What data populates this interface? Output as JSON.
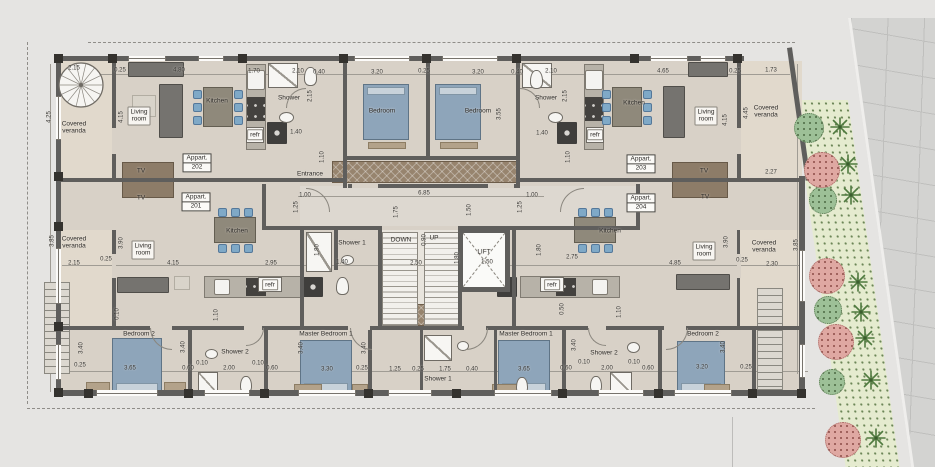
{
  "plan": {
    "apartments": [
      {
        "title": "Appart.",
        "number": "202",
        "x": 197,
        "y": 163
      },
      {
        "title": "Appart.",
        "number": "201",
        "x": 196,
        "y": 202
      },
      {
        "title": "Appart.",
        "number": "203",
        "x": 641,
        "y": 164
      },
      {
        "title": "Appart.",
        "number": "204",
        "x": 641,
        "y": 203
      }
    ],
    "labels": [
      {
        "t": "Covered\nveranda",
        "x": 74,
        "y": 128,
        "cls": "room"
      },
      {
        "t": "Covered\nveranda",
        "x": 74,
        "y": 243,
        "cls": "room"
      },
      {
        "t": "Covered\nveranda",
        "x": 766,
        "y": 112,
        "cls": "room"
      },
      {
        "t": "Covered\nveranda",
        "x": 764,
        "y": 247,
        "cls": "room"
      },
      {
        "t": "Living\nroom",
        "x": 139,
        "y": 116,
        "cls": "roombox"
      },
      {
        "t": "Living\nroom",
        "x": 706,
        "y": 116,
        "cls": "roombox"
      },
      {
        "t": "Living\nroom",
        "x": 143,
        "y": 250,
        "cls": "roombox"
      },
      {
        "t": "Living\nroom",
        "x": 704,
        "y": 251,
        "cls": "roombox"
      },
      {
        "t": "Kitchen",
        "x": 217,
        "y": 101,
        "cls": "room"
      },
      {
        "t": "Kitchen",
        "x": 634,
        "y": 103,
        "cls": "room"
      },
      {
        "t": "Kitchen",
        "x": 237,
        "y": 231,
        "cls": "room"
      },
      {
        "t": "Kitchen",
        "x": 610,
        "y": 231,
        "cls": "room"
      },
      {
        "t": "Shower",
        "x": 289,
        "y": 98,
        "cls": "room"
      },
      {
        "t": "Shower",
        "x": 546,
        "y": 98,
        "cls": "room"
      },
      {
        "t": "Shower 1",
        "x": 352,
        "y": 243,
        "cls": "room"
      },
      {
        "t": "Shower 1",
        "x": 438,
        "y": 379,
        "cls": "room"
      },
      {
        "t": "Shower 2",
        "x": 235,
        "y": 352,
        "cls": "room"
      },
      {
        "t": "Shower 2",
        "x": 604,
        "y": 353,
        "cls": "room"
      },
      {
        "t": "Bedroom",
        "x": 382,
        "y": 111,
        "cls": "room"
      },
      {
        "t": "Bedroom",
        "x": 478,
        "y": 111,
        "cls": "room"
      },
      {
        "t": "Bedroom 2",
        "x": 139,
        "y": 334,
        "cls": "room"
      },
      {
        "t": "Bedroom 2",
        "x": 703,
        "y": 334,
        "cls": "room"
      },
      {
        "t": "Master Bedroom 1",
        "x": 326,
        "y": 334,
        "cls": "room"
      },
      {
        "t": "Master Bedroom 1",
        "x": 526,
        "y": 334,
        "cls": "room"
      },
      {
        "t": "refr",
        "x": 255,
        "y": 135,
        "cls": "roombox"
      },
      {
        "t": "refr",
        "x": 595,
        "y": 135,
        "cls": "roombox"
      },
      {
        "t": "refr",
        "x": 270,
        "y": 285,
        "cls": "roombox"
      },
      {
        "t": "refr",
        "x": 552,
        "y": 285,
        "cls": "roombox"
      },
      {
        "t": "TV",
        "x": 141,
        "y": 171,
        "cls": "room"
      },
      {
        "t": "TV",
        "x": 141,
        "y": 198,
        "cls": "room"
      },
      {
        "t": "TV",
        "x": 704,
        "y": 171,
        "cls": "room"
      },
      {
        "t": "TV",
        "x": 705,
        "y": 197,
        "cls": "room"
      },
      {
        "t": "Entrance",
        "x": 310,
        "y": 174,
        "cls": "room"
      },
      {
        "t": "DOWN",
        "x": 401,
        "y": 240,
        "cls": "room"
      },
      {
        "t": "UP",
        "x": 434,
        "y": 238,
        "cls": "room"
      },
      {
        "t": "LIFT",
        "x": 484,
        "y": 252,
        "cls": "room"
      }
    ],
    "dims": [
      {
        "t": "2.15",
        "x": 74,
        "y": 69
      },
      {
        "t": "0.25",
        "x": 120,
        "y": 71
      },
      {
        "t": "4.80",
        "x": 179,
        "y": 71
      },
      {
        "t": "1.70",
        "x": 254,
        "y": 72
      },
      {
        "t": "2.10",
        "x": 298,
        "y": 72
      },
      {
        "t": "0.40",
        "x": 319,
        "y": 73
      },
      {
        "t": "3.20",
        "x": 377,
        "y": 73
      },
      {
        "t": "0.25",
        "x": 424,
        "y": 72
      },
      {
        "t": "3.20",
        "x": 478,
        "y": 73
      },
      {
        "t": "0.40",
        "x": 517,
        "y": 73
      },
      {
        "t": "2.10",
        "x": 551,
        "y": 72
      },
      {
        "t": "4.65",
        "x": 663,
        "y": 72
      },
      {
        "t": "0.25",
        "x": 735,
        "y": 72
      },
      {
        "t": "1.73",
        "x": 771,
        "y": 71
      },
      {
        "t": "4.25",
        "x": 50,
        "y": 117,
        "r": 90
      },
      {
        "t": "4.15",
        "x": 122,
        "y": 117,
        "r": 90
      },
      {
        "t": "2.15",
        "x": 311,
        "y": 96,
        "r": 90
      },
      {
        "t": "2.15",
        "x": 566,
        "y": 96,
        "r": 90
      },
      {
        "t": "3.55",
        "x": 500,
        "y": 114,
        "r": 90
      },
      {
        "t": "4.45",
        "x": 747,
        "y": 113,
        "r": 90
      },
      {
        "t": "4.15",
        "x": 726,
        "y": 120,
        "r": 90
      },
      {
        "t": "1.10",
        "x": 323,
        "y": 157,
        "r": 90
      },
      {
        "t": "1.10",
        "x": 569,
        "y": 157,
        "r": 90
      },
      {
        "t": "1.40",
        "x": 296,
        "y": 133
      },
      {
        "t": "1.40",
        "x": 542,
        "y": 134
      },
      {
        "t": "2.27",
        "x": 771,
        "y": 173
      },
      {
        "t": "1.00",
        "x": 305,
        "y": 196
      },
      {
        "t": "6.85",
        "x": 424,
        "y": 194
      },
      {
        "t": "1.00",
        "x": 532,
        "y": 196
      },
      {
        "t": "2.50",
        "x": 416,
        "y": 264
      },
      {
        "t": "1.50",
        "x": 487,
        "y": 263
      },
      {
        "t": "1.40",
        "x": 342,
        "y": 263
      },
      {
        "t": "2.15",
        "x": 74,
        "y": 264
      },
      {
        "t": "0.25",
        "x": 106,
        "y": 260
      },
      {
        "t": "4.15",
        "x": 173,
        "y": 264
      },
      {
        "t": "2.95",
        "x": 271,
        "y": 264
      },
      {
        "t": "2.75",
        "x": 572,
        "y": 258
      },
      {
        "t": "4.85",
        "x": 675,
        "y": 264
      },
      {
        "t": "0.25",
        "x": 742,
        "y": 261
      },
      {
        "t": "2.30",
        "x": 772,
        "y": 265
      },
      {
        "t": "1.25",
        "x": 297,
        "y": 207,
        "r": 90
      },
      {
        "t": "1.75",
        "x": 397,
        "y": 212,
        "r": 90
      },
      {
        "t": "1.50",
        "x": 470,
        "y": 210,
        "r": 90
      },
      {
        "t": "1.25",
        "x": 521,
        "y": 207,
        "r": 90
      },
      {
        "t": "1.80",
        "x": 458,
        "y": 258,
        "r": 90
      },
      {
        "t": "0.90",
        "x": 425,
        "y": 240,
        "r": 90
      },
      {
        "t": "3.85",
        "x": 53,
        "y": 241,
        "r": 90
      },
      {
        "t": "3.90",
        "x": 122,
        "y": 243,
        "r": 90
      },
      {
        "t": "1.80",
        "x": 318,
        "y": 250,
        "r": 90
      },
      {
        "t": "1.80",
        "x": 540,
        "y": 250,
        "r": 90
      },
      {
        "t": "3.90",
        "x": 727,
        "y": 242,
        "r": 90
      },
      {
        "t": "3.85",
        "x": 797,
        "y": 245,
        "r": 90
      },
      {
        "t": "0.25",
        "x": 80,
        "y": 366
      },
      {
        "t": "3.65",
        "x": 130,
        "y": 369
      },
      {
        "t": "0.60",
        "x": 188,
        "y": 369
      },
      {
        "t": "0.10",
        "x": 202,
        "y": 364
      },
      {
        "t": "2.00",
        "x": 229,
        "y": 369
      },
      {
        "t": "0.10",
        "x": 258,
        "y": 364
      },
      {
        "t": "0.60",
        "x": 272,
        "y": 369
      },
      {
        "t": "3.30",
        "x": 327,
        "y": 370
      },
      {
        "t": "0.25",
        "x": 362,
        "y": 369
      },
      {
        "t": "1.25",
        "x": 395,
        "y": 370
      },
      {
        "t": "0.25",
        "x": 418,
        "y": 370
      },
      {
        "t": "1.75",
        "x": 445,
        "y": 370
      },
      {
        "t": "0.40",
        "x": 472,
        "y": 370
      },
      {
        "t": "3.65",
        "x": 524,
        "y": 370
      },
      {
        "t": "0.60",
        "x": 566,
        "y": 369
      },
      {
        "t": "2.00",
        "x": 607,
        "y": 369
      },
      {
        "t": "0.10",
        "x": 584,
        "y": 363
      },
      {
        "t": "0.10",
        "x": 634,
        "y": 363
      },
      {
        "t": "0.60",
        "x": 648,
        "y": 369
      },
      {
        "t": "3.20",
        "x": 702,
        "y": 368
      },
      {
        "t": "0.25",
        "x": 746,
        "y": 368
      },
      {
        "t": "3.40",
        "x": 82,
        "y": 348,
        "r": 90
      },
      {
        "t": "3.40",
        "x": 184,
        "y": 347,
        "r": 90
      },
      {
        "t": "3.40",
        "x": 302,
        "y": 348,
        "r": 90
      },
      {
        "t": "3.40",
        "x": 365,
        "y": 348,
        "r": 90
      },
      {
        "t": "3.40",
        "x": 575,
        "y": 345,
        "r": 90
      },
      {
        "t": "3.40",
        "x": 724,
        "y": 347,
        "r": 90
      },
      {
        "t": "1.10",
        "x": 217,
        "y": 315,
        "r": 90
      },
      {
        "t": "1.10",
        "x": 620,
        "y": 312,
        "r": 90
      },
      {
        "t": "0.50",
        "x": 563,
        "y": 309,
        "r": 90
      },
      {
        "t": "0.10",
        "x": 118,
        "y": 314,
        "r": 90
      }
    ],
    "garden": {
      "trees_green": [
        [
          809,
          128,
          15
        ],
        [
          823,
          200,
          14
        ],
        [
          828,
          310,
          14
        ],
        [
          832,
          382,
          13
        ]
      ],
      "trees_pink": [
        [
          822,
          170,
          18
        ],
        [
          827,
          276,
          18
        ],
        [
          836,
          342,
          18
        ],
        [
          843,
          440,
          18
        ]
      ],
      "palms": [
        [
          840,
          127
        ],
        [
          848,
          164
        ],
        [
          851,
          195
        ],
        [
          858,
          282
        ],
        [
          861,
          312
        ],
        [
          865,
          338
        ],
        [
          871,
          380
        ],
        [
          876,
          438
        ]
      ]
    },
    "colors": {
      "bed": "#8ea5ba",
      "chair": "#7fa9c7",
      "wall": "#5f5e5c",
      "tree_green": "#9dc097",
      "tree_pink": "#dfa8a2",
      "palm": "#4f7a3f",
      "floor": "#d8d1c7",
      "garden": "#e5ebcf"
    }
  }
}
